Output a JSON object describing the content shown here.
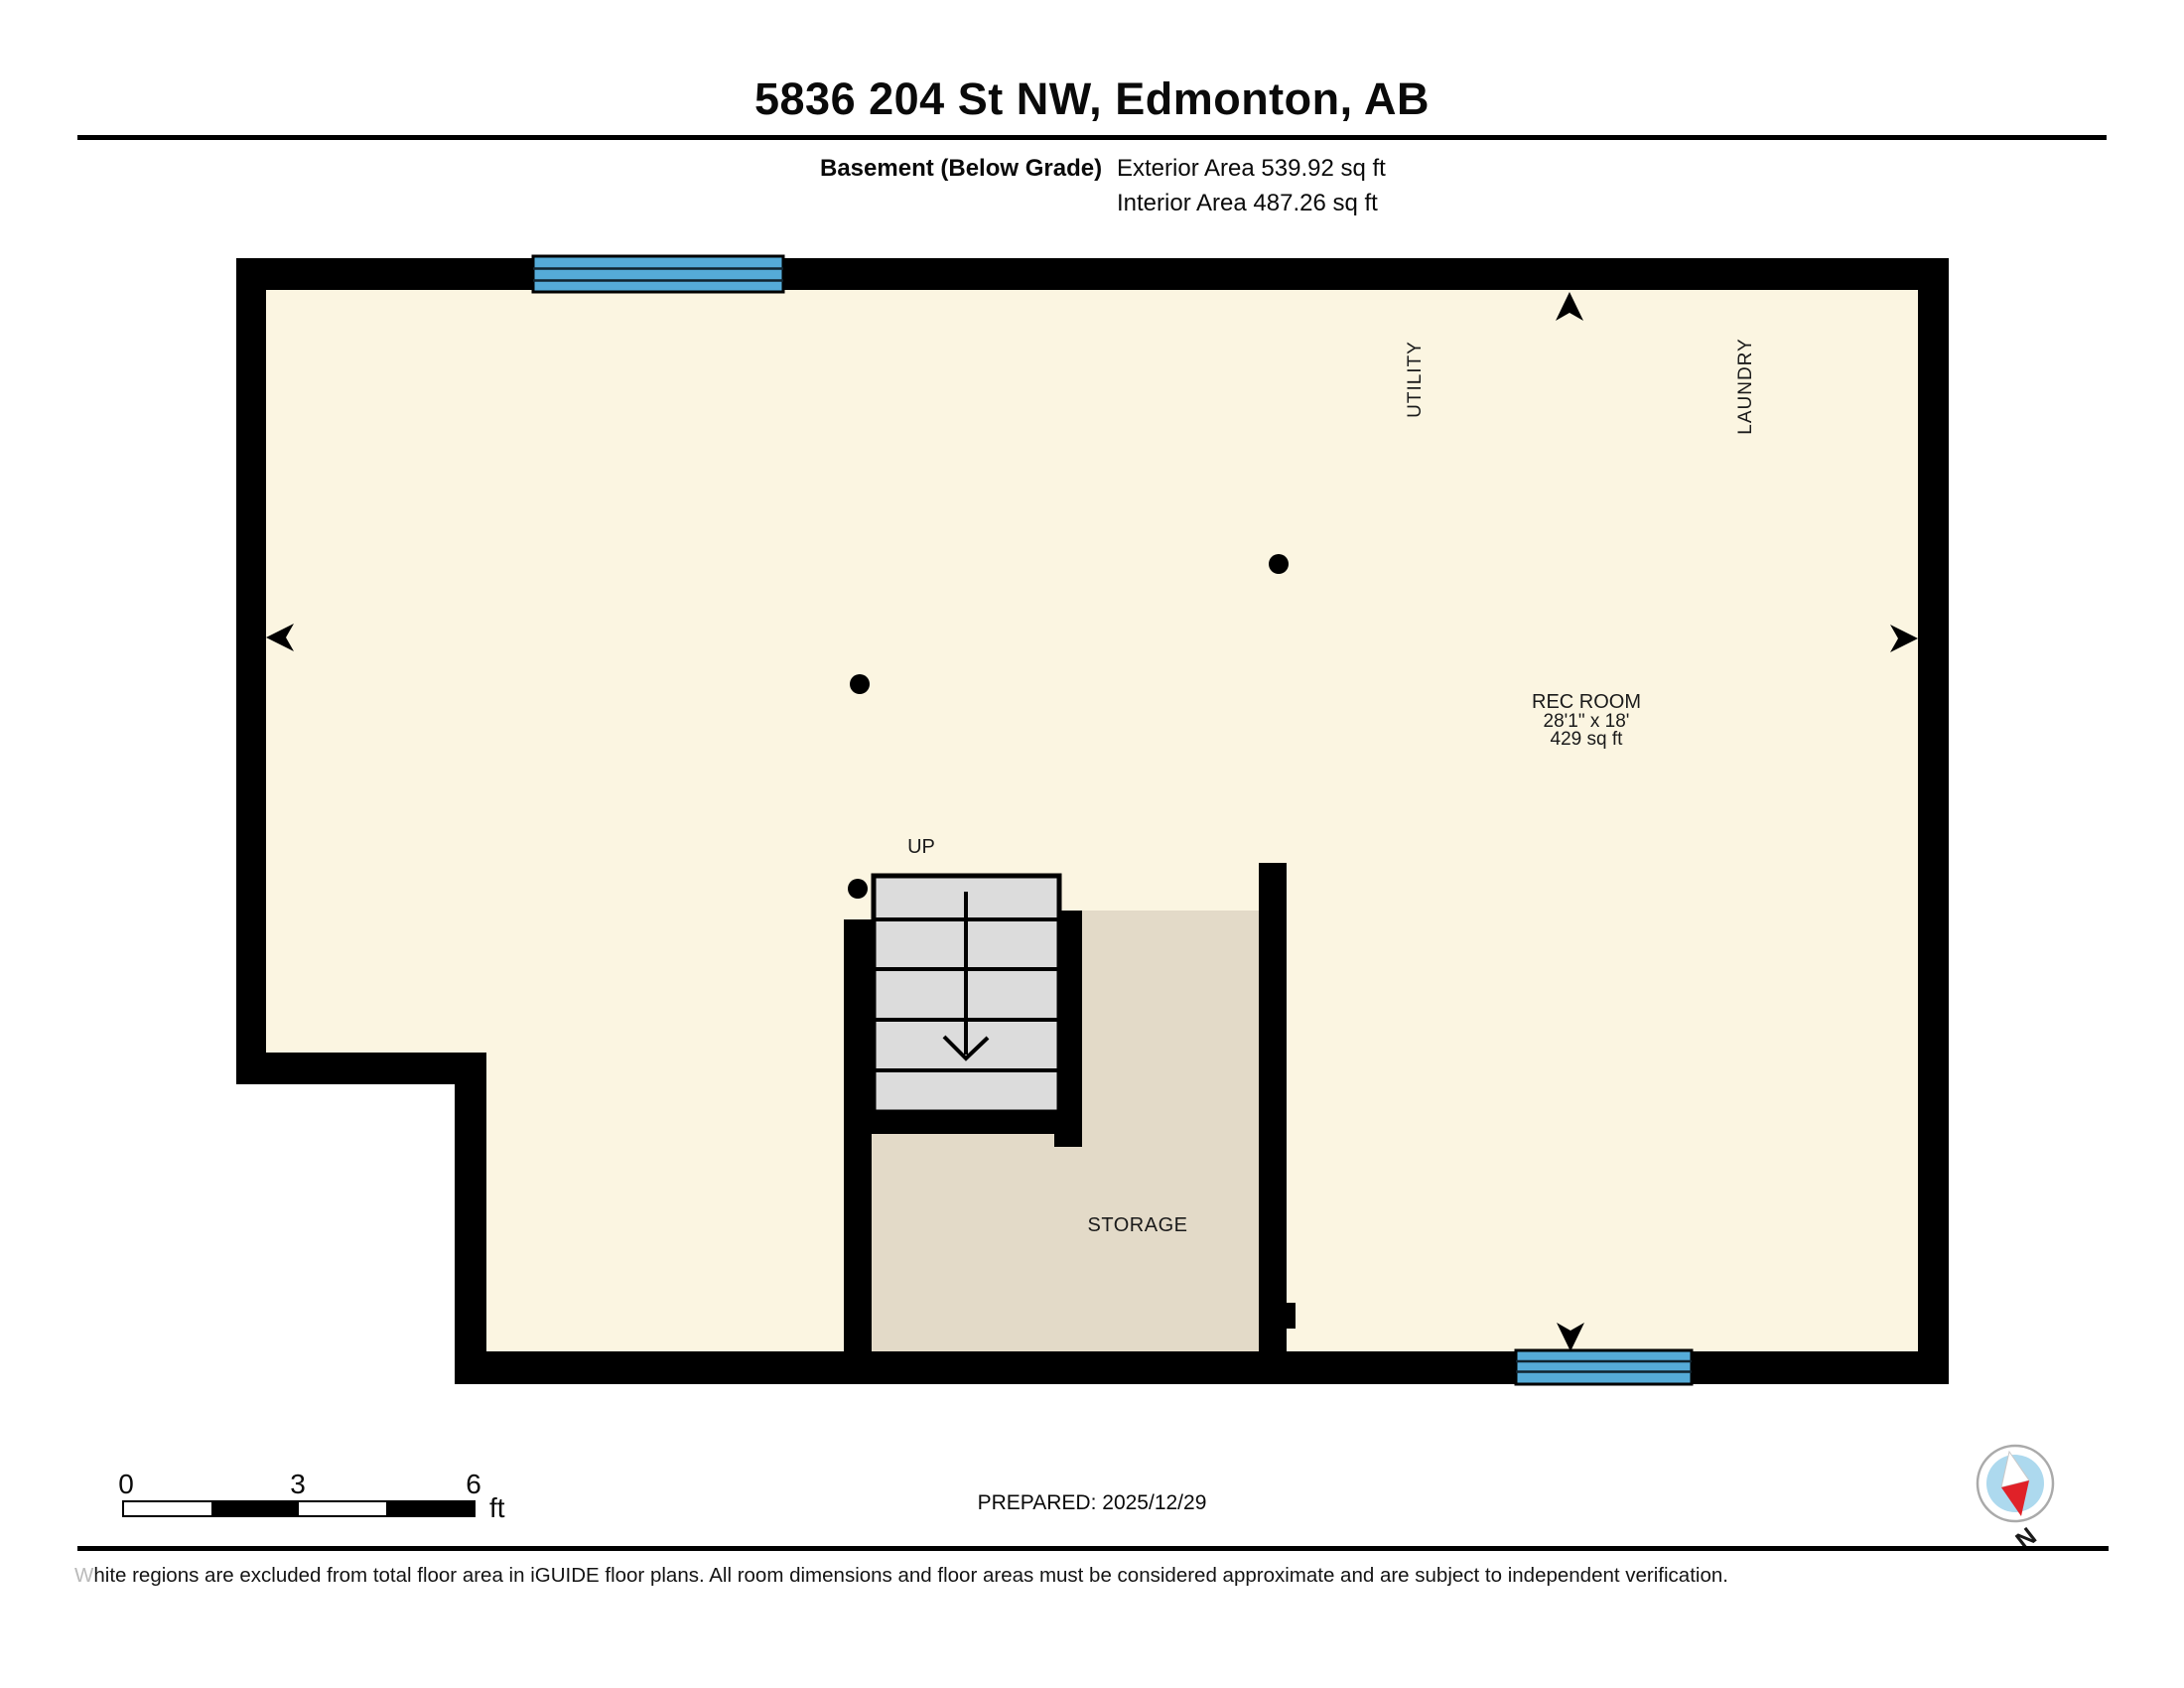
{
  "header": {
    "title": "5836 204 St NW, Edmonton, AB",
    "floor_label": "Basement (Below Grade)",
    "exterior_area": "Exterior Area 539.92 sq ft",
    "interior_area": "Interior Area 487.26 sq ft"
  },
  "plan": {
    "rec_room": {
      "name": "REC ROOM",
      "dimensions": "28'1\" x 18'",
      "area": "429 sq ft"
    },
    "utility_label": "UTILITY",
    "laundry_label": "LAUNDRY",
    "storage_label": "STORAGE",
    "stairs_label": "UP",
    "colors": {
      "interior_floor": "#FBF5E1",
      "storage_floor": "#E3DAC8",
      "stair_fill": "#DCDCDC",
      "window_blue": "#55ABD8",
      "wall_black": "#000000"
    }
  },
  "scale_bar": {
    "ticks": [
      "0",
      "3",
      "6"
    ],
    "unit": "ft"
  },
  "footer": {
    "prepared": "PREPARED: 2025/12/29",
    "compass_label": "N",
    "compass_colors": {
      "ring": "#aaaaaa",
      "face": "#ADD9EE",
      "needle_red": "#E02128"
    },
    "disclaimer": "White regions are excluded from total floor area in iGUIDE floor plans. All room dimensions and floor areas must be considered approximate and are subject to independent verification."
  }
}
